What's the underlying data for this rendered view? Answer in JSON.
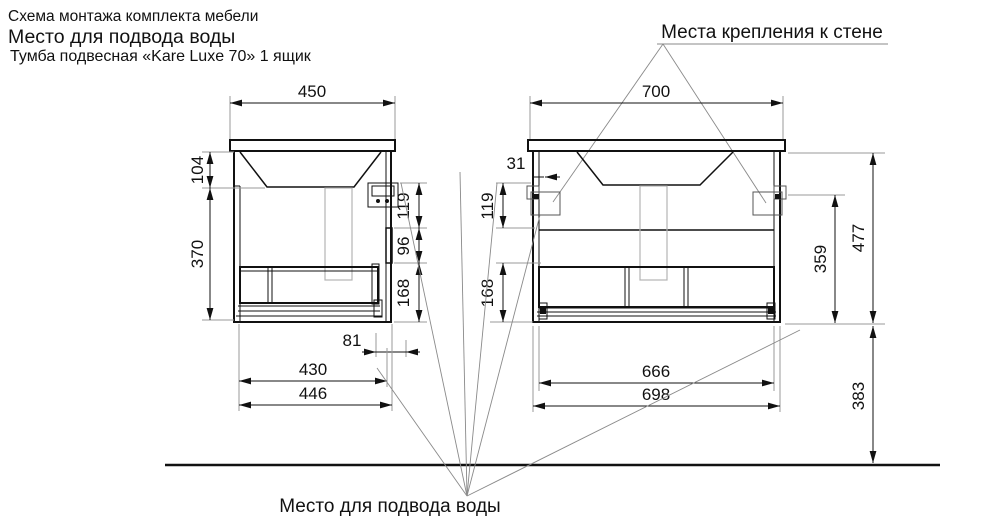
{
  "header": {
    "line1": "Схема монтажа комплекта мебели",
    "line2": "Место для подвода воды",
    "line3": "Тумба подвесная «Kare Luxe 70» 1 ящик"
  },
  "labels": {
    "wall_mount": "Места крепления к стене",
    "water_supply": "Место для подвода воды"
  },
  "side_view": {
    "top_width": "450",
    "basin_depth": "104",
    "body_height": "370",
    "hook_offset": "119",
    "handle_zone": "96",
    "bottom_zone": "168",
    "back_offset": "81",
    "inner_width": "430",
    "outer_width": "446"
  },
  "front_view": {
    "top_width": "700",
    "edge_offset": "31",
    "hook_offset": "119",
    "bottom_zone": "168",
    "hook_height": "359",
    "body_height": "477",
    "floor_gap": "383",
    "inner_width": "666",
    "outer_width": "698"
  }
}
